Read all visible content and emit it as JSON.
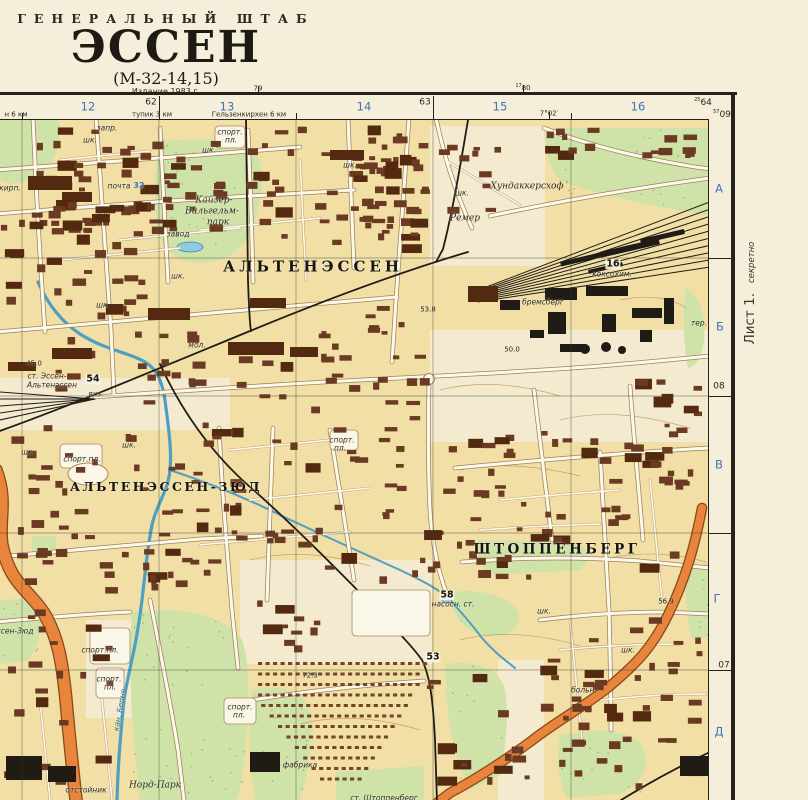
{
  "sheet": {
    "agency": "ГЕНЕРАЛЬНЫЙ ШТАБ",
    "title": "ЭССЕН",
    "code": "(М-32-14,15)",
    "edition": "Издание 1983 г.",
    "sheet_note": "Лист 1.",
    "secrecy": "секретно"
  },
  "margins": {
    "top": [
      {
        "t": "12",
        "x": 88,
        "y": 107,
        "c": "m-blue"
      },
      {
        "t": "13",
        "x": 227,
        "y": 107,
        "c": "m-blue"
      },
      {
        "t": "14",
        "x": 364,
        "y": 107,
        "c": "m-blue"
      },
      {
        "t": "15",
        "x": 500,
        "y": 107,
        "c": "m-blue"
      },
      {
        "t": "16",
        "x": 638,
        "y": 107,
        "c": "m-blue"
      },
      {
        "t": "62",
        "x": 151,
        "y": 103,
        "c": "m-black"
      },
      {
        "t": "63",
        "x": 425,
        "y": 103,
        "c": "m-black"
      },
      {
        "t": "64",
        "x": 703,
        "y": 103,
        "c": "m-black",
        "sup": "25"
      },
      {
        "t": "09",
        "x": 722,
        "y": 115,
        "c": "m-black",
        "sup": "57"
      },
      {
        "t": "79",
        "x": 258,
        "y": 89,
        "c": "m-small"
      },
      {
        "t": "80",
        "x": 523,
        "y": 88,
        "c": "m-small",
        "sup": "17"
      },
      {
        "t": "н 6 км",
        "x": 16,
        "y": 115,
        "c": "m-small"
      },
      {
        "t": "тупик 3 км",
        "x": 152,
        "y": 115,
        "c": "m-small"
      },
      {
        "t": "Гельзенкирхен 6 км",
        "x": 249,
        "y": 115,
        "c": "m-small"
      },
      {
        "t": "7°02′",
        "x": 549,
        "y": 114,
        "c": "m-small"
      }
    ],
    "right": [
      {
        "t": "А",
        "x": 719,
        "y": 189,
        "c": "m-blue"
      },
      {
        "t": "Б",
        "x": 720,
        "y": 327,
        "c": "m-blue"
      },
      {
        "t": "В",
        "x": 719,
        "y": 465,
        "c": "m-blue"
      },
      {
        "t": "Г",
        "x": 717,
        "y": 599,
        "c": "m-blue"
      },
      {
        "t": "Д",
        "x": 719,
        "y": 732,
        "c": "m-blue"
      },
      {
        "t": "08",
        "x": 719,
        "y": 387,
        "c": "m-black"
      },
      {
        "t": "07",
        "x": 724,
        "y": 666,
        "c": "m-black"
      }
    ]
  },
  "map": {
    "labels": [
      {
        "t": "АЛЬТЕНЭССЕН",
        "x": 313,
        "y": 267,
        "c": "town",
        "s": 15,
        "ls": 4
      },
      {
        "t": "АЛЬТЕНЭССЕН-ЗЮД",
        "x": 166,
        "y": 487,
        "c": "town",
        "s": 12.5,
        "ls": 2.5
      },
      {
        "t": "ШТОППЕНБЕРГ",
        "x": 557,
        "y": 550,
        "c": "town",
        "s": 13.5,
        "ls": 3.5
      },
      {
        "t": "запр.",
        "x": 107,
        "y": 128,
        "c": "obj-i"
      },
      {
        "t": "шк.",
        "x": 90,
        "y": 140,
        "c": "obj-i"
      },
      {
        "t": "спорт.",
        "x": 230,
        "y": 132,
        "c": "obj-i"
      },
      {
        "t": "пл.",
        "x": 231,
        "y": 140,
        "c": "obj-i"
      },
      {
        "t": "шк.",
        "x": 209,
        "y": 150,
        "c": "obj-i"
      },
      {
        "t": "шк.",
        "x": 350,
        "y": 165,
        "c": "obj-i"
      },
      {
        "t": "кирп.",
        "x": 10,
        "y": 188,
        "c": "obj-i"
      },
      {
        "t": "почта",
        "x": 119,
        "y": 186,
        "c": "obj-i"
      },
      {
        "t": "32",
        "x": 139,
        "y": 186,
        "c": "blue-num"
      },
      {
        "t": "Кайзер-",
        "x": 214,
        "y": 201,
        "c": "park"
      },
      {
        "t": "Вильгельм-",
        "x": 212,
        "y": 212,
        "c": "park"
      },
      {
        "t": "парк",
        "x": 218,
        "y": 223,
        "c": "park"
      },
      {
        "t": "завод",
        "x": 178,
        "y": 234,
        "c": "obj-i"
      },
      {
        "t": "шк.",
        "x": 178,
        "y": 276,
        "c": "obj-i"
      },
      {
        "t": "Хундаккерсхоф",
        "x": 527,
        "y": 187,
        "c": "name-i"
      },
      {
        "t": "шк.",
        "x": 462,
        "y": 193,
        "c": "obj-i"
      },
      {
        "t": "Ремер",
        "x": 465,
        "y": 219,
        "c": "name-i"
      },
      {
        "t": "16",
        "x": 613,
        "y": 264,
        "c": "gridnum"
      },
      {
        "t": "коксохим.",
        "x": 612,
        "y": 274,
        "c": "obj-i"
      },
      {
        "t": "бремсберг",
        "x": 543,
        "y": 302,
        "c": "obj-i"
      },
      {
        "t": "мол.",
        "x": 197,
        "y": 345,
        "c": "obj-i"
      },
      {
        "t": "шк.",
        "x": 103,
        "y": 305,
        "c": "obj-i"
      },
      {
        "t": "53.8",
        "x": 428,
        "y": 310,
        "c": "height"
      },
      {
        "t": "50.0",
        "x": 512,
        "y": 350,
        "c": "height"
      },
      {
        "t": "тер.",
        "x": 699,
        "y": 323,
        "c": "obj-i"
      },
      {
        "t": "45.0",
        "x": 34,
        "y": 364,
        "c": "height"
      },
      {
        "t": "ст. Эссен-",
        "x": 47,
        "y": 376,
        "c": "obj-i"
      },
      {
        "t": "Альтенэссен",
        "x": 52,
        "y": 385,
        "c": "obj-i"
      },
      {
        "t": "54",
        "x": 93,
        "y": 379,
        "c": "gridnum"
      },
      {
        "t": "вкз.",
        "x": 96,
        "y": 394,
        "c": "obj-i"
      },
      {
        "t": "шк.",
        "x": 28,
        "y": 452,
        "c": "obj-i"
      },
      {
        "t": "спорт.пл.",
        "x": 82,
        "y": 459,
        "c": "obj-i"
      },
      {
        "t": "шк.",
        "x": 129,
        "y": 445,
        "c": "obj-i"
      },
      {
        "t": "спорт.",
        "x": 342,
        "y": 440,
        "c": "obj-i"
      },
      {
        "t": "пл.",
        "x": 340,
        "y": 448,
        "c": "obj-i"
      },
      {
        "t": "58",
        "x": 447,
        "y": 595,
        "c": "gridnum"
      },
      {
        "t": "насосн. ст.",
        "x": 453,
        "y": 604,
        "c": "obj-i"
      },
      {
        "t": "шк.",
        "x": 544,
        "y": 611,
        "c": "obj-i"
      },
      {
        "t": "56.9",
        "x": 666,
        "y": 602,
        "c": "height"
      },
      {
        "t": "53",
        "x": 433,
        "y": 657,
        "c": "gridnum"
      },
      {
        "t": "72.3",
        "x": 310,
        "y": 676,
        "c": "height"
      },
      {
        "t": "ссен-Зюд",
        "x": 15,
        "y": 631,
        "c": "obj-i"
      },
      {
        "t": "спорт.пл.",
        "x": 100,
        "y": 650,
        "c": "obj-i"
      },
      {
        "t": "спорт.",
        "x": 109,
        "y": 679,
        "c": "obj-i"
      },
      {
        "t": "пл.",
        "x": 110,
        "y": 687,
        "c": "obj-i"
      },
      {
        "t": "кан. Берне",
        "x": 120,
        "y": 710,
        "c": "water-i",
        "r": -80
      },
      {
        "t": "спорт.",
        "x": 240,
        "y": 707,
        "c": "obj-i"
      },
      {
        "t": "пл.",
        "x": 239,
        "y": 715,
        "c": "obj-i"
      },
      {
        "t": "отстойник",
        "x": 86,
        "y": 790,
        "c": "obj-i"
      },
      {
        "t": "Норд-Парк",
        "x": 155,
        "y": 786,
        "c": "park"
      },
      {
        "t": "фабрика",
        "x": 300,
        "y": 765,
        "c": "obj-i"
      },
      {
        "t": "ст. Штоппенберг",
        "x": 384,
        "y": 798,
        "c": "obj-i"
      },
      {
        "t": "больн.",
        "x": 584,
        "y": 690,
        "c": "obj-i"
      },
      {
        "t": "шк.",
        "x": 628,
        "y": 650,
        "c": "obj-i"
      }
    ]
  },
  "colors": {
    "paper": "#f4eeda",
    "land": "#f1dfa6",
    "pale": "#f4ead0",
    "park": "#cfe3a9",
    "water": "#4d9fc4",
    "water_fill": "#8ecbe2",
    "building": "#6a3b22",
    "building_dark": "#53290f",
    "industrial": "#201b15",
    "rail": "#201c16",
    "road_fill": "#fcf8ea",
    "road_casing": "#a08058",
    "minor_casing": "#b39066",
    "highway": "#e8843c",
    "highway_casing": "#8a4a1a",
    "grid": "#3c382f",
    "blue_text": "#3f74b8",
    "black_text": "#2c2822",
    "contour": "#c09058"
  }
}
